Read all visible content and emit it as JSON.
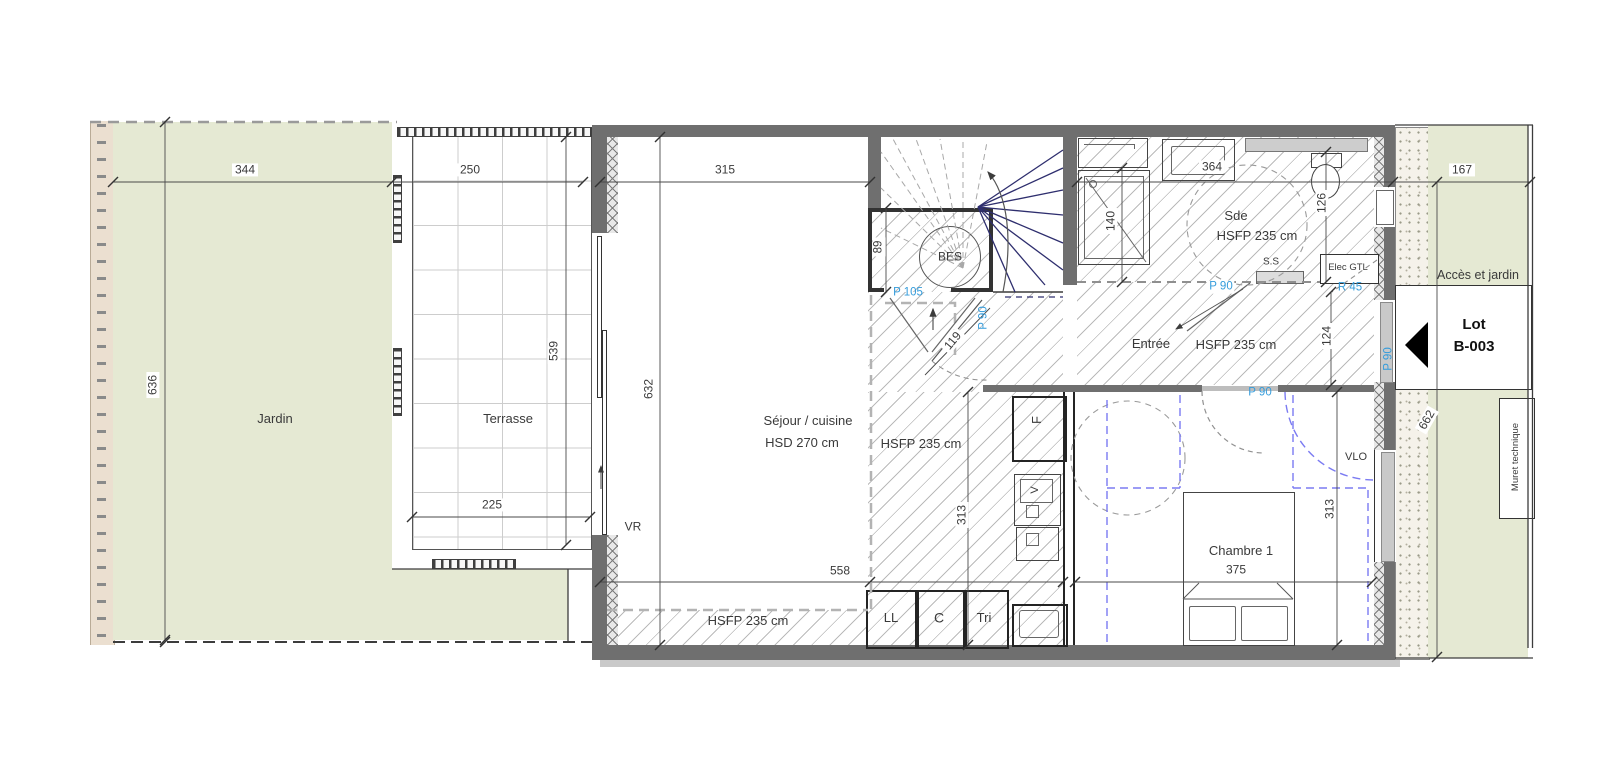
{
  "colors": {
    "garden_green": "#e5e9d3",
    "fence_beige": "#ebdfd0",
    "wall_gray": "#6f6f6f",
    "door_label_blue": "#359cdb",
    "stair_navy": "#2e2e6e",
    "furniture_blue": "#7b7bf2"
  },
  "areas": {
    "jardin": "Jardin",
    "terrasse": "Terrasse",
    "acces_jardin": "Accès et jardin",
    "muret_technique": "Muret technique"
  },
  "lot": {
    "title": "Lot",
    "number": "B-003"
  },
  "rooms": {
    "sejour": {
      "name": "Séjour / cuisine",
      "ceiling": "HSD 270 cm",
      "ceiling_low": "HSFP 235 cm"
    },
    "entree": {
      "name": "Entrée",
      "ceiling_low": "HSFP 235 cm"
    },
    "sde": {
      "name": "Sde",
      "ceiling_low": "HSFP 235 cm"
    },
    "chambre": {
      "name": "Chambre 1"
    },
    "bes": "BES",
    "bottom_ceiling_low": "HSFP 235 cm"
  },
  "equipment": {
    "ll": "LL",
    "c": "C",
    "tri": "Tri",
    "f": "F",
    "v": "V",
    "vr": "VR",
    "vlo": "VLO",
    "ss": "S.S",
    "elec_gtl": "Elec GTL"
  },
  "doors": {
    "p105": "P 105",
    "p90_stair": "P 90",
    "p90_sde": "P 90",
    "r45": "R 45",
    "p90_chambre": "P 90",
    "p90_entry": "P 90"
  },
  "dims": {
    "d344": "344",
    "d250": "250",
    "d315": "315",
    "d364": "364",
    "d167": "167",
    "d636": "636",
    "d539": "539",
    "d632": "632",
    "d89": "89",
    "d140": "140",
    "d126": "126",
    "d119": "119",
    "d124": "124",
    "d313_kitchen": "313",
    "d313_chambre": "313",
    "d225": "225",
    "d558": "558",
    "d375": "375",
    "d662": "662"
  }
}
